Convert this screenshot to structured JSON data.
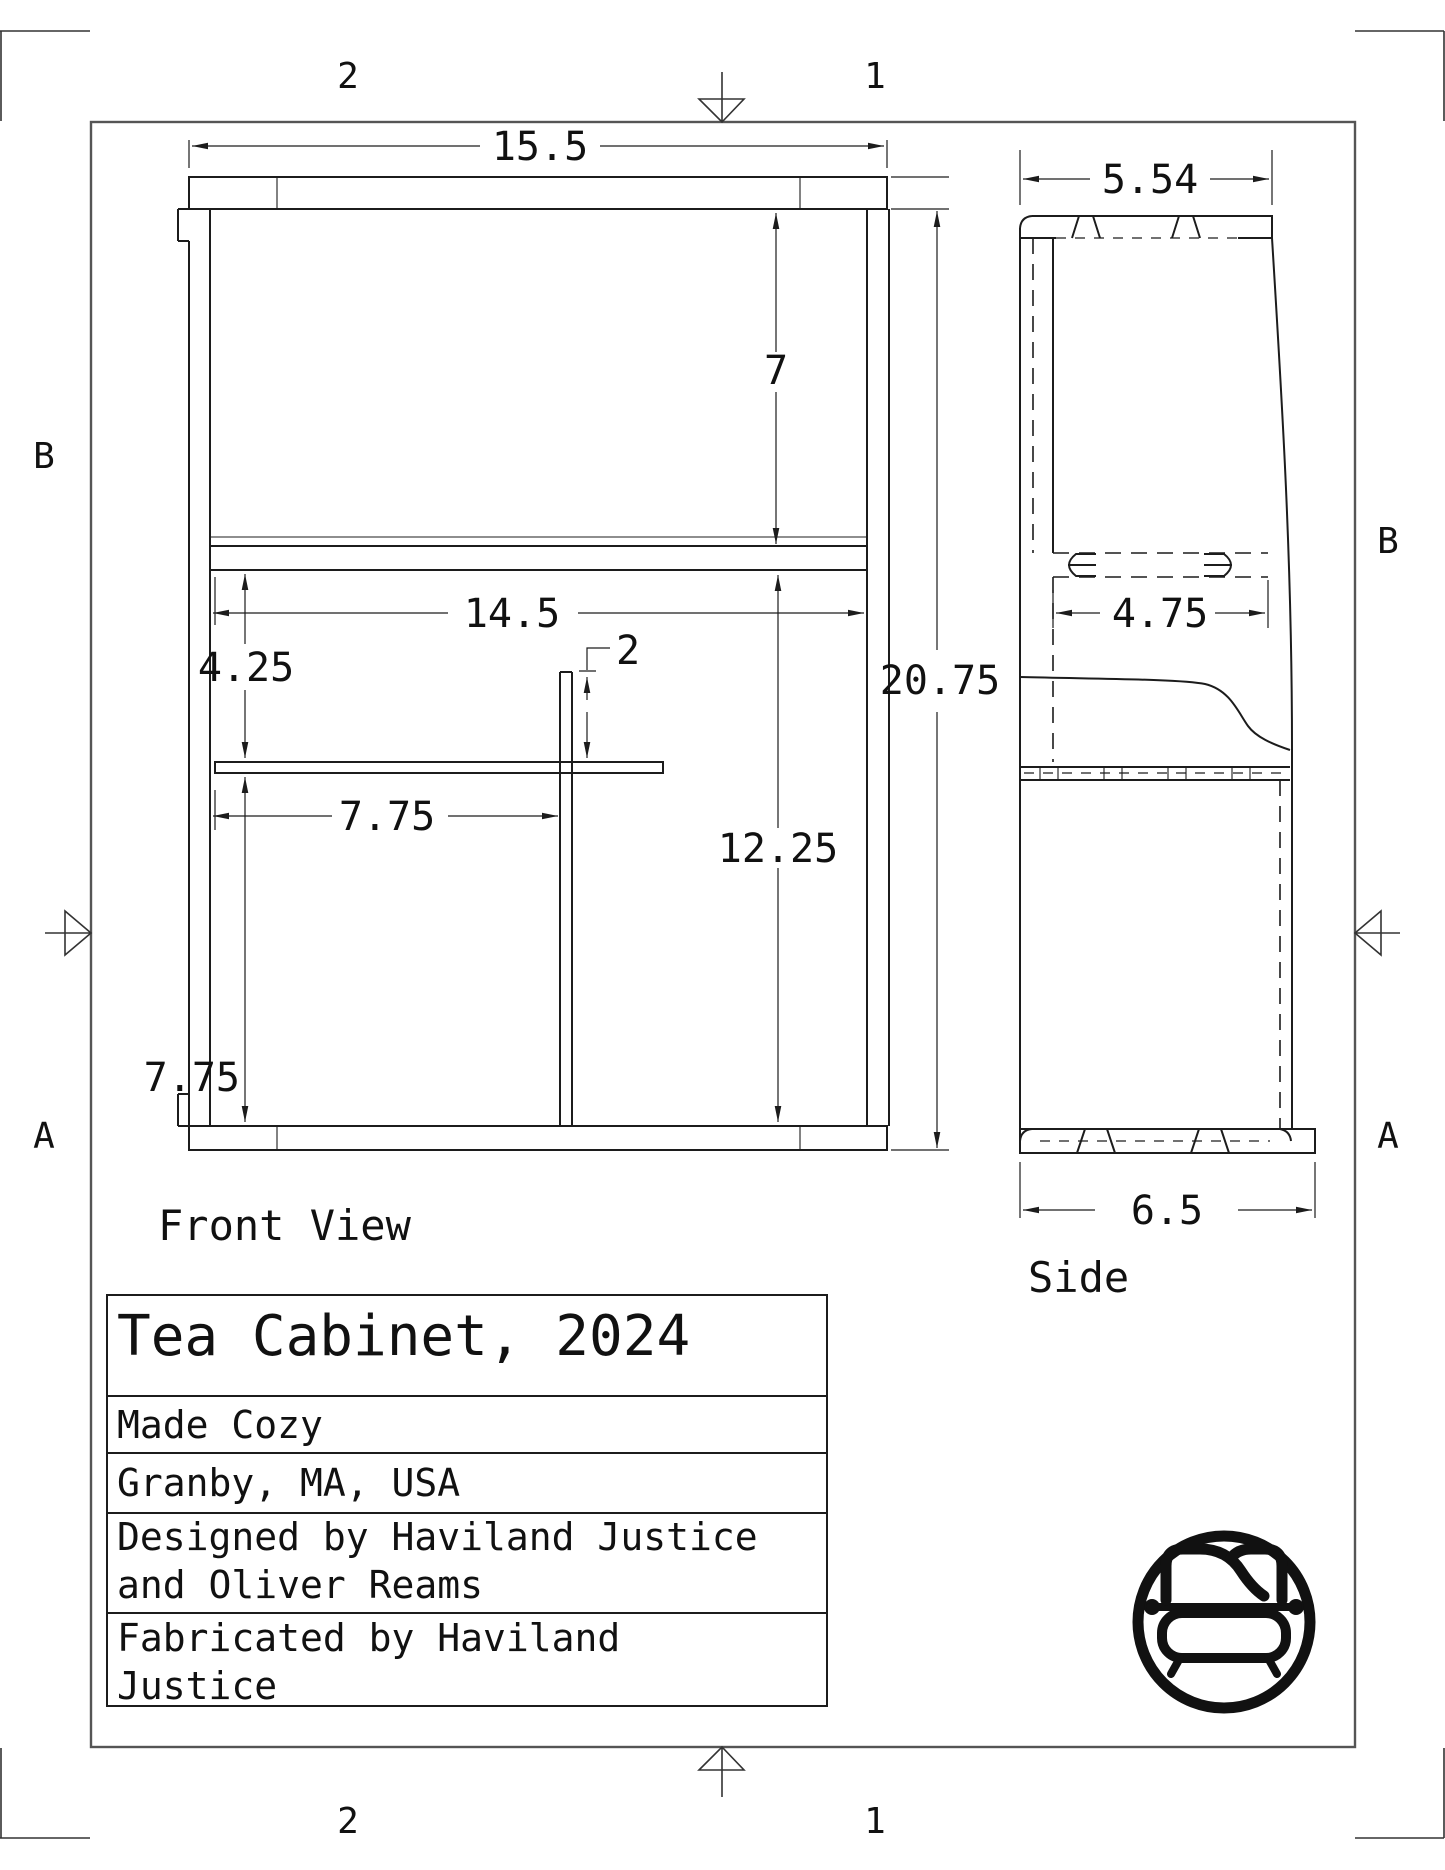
{
  "sheet": {
    "zones": {
      "top_left": "2",
      "top_right": "1",
      "bottom_left": "2",
      "bottom_right": "1",
      "left_upper": "B",
      "left_lower": "A",
      "right_upper": "B",
      "right_lower": "A"
    },
    "line_color": "#1c1c1c",
    "border_color": "#555555",
    "background": "#ffffff"
  },
  "front_view": {
    "label": "Front View",
    "dims": {
      "overall_width": "15.5",
      "top_opening_height": "7",
      "interior_width": "14.5",
      "shelf_gap": "4.25",
      "divider_reveal": "2",
      "right_opening_height": "12.25",
      "shelf_length": "7.75",
      "left_opening_height": "7.75",
      "overall_height": "20.75"
    }
  },
  "side_view": {
    "label": "Side",
    "dims": {
      "top_depth": "5.54",
      "shelf_depth": "4.75",
      "base_depth": "6.5"
    }
  },
  "title_block": {
    "title": "Tea Cabinet, 2024",
    "maker": "Made Cozy",
    "location": "Granby, MA, USA",
    "designed_line1": "Designed by Haviland Justice",
    "designed_line2": "and Oliver Reams",
    "fabricated_line1": "Fabricated by Haviland",
    "fabricated_line2": "Justice"
  },
  "logo": {
    "name": "made-cozy-bed-logo"
  }
}
